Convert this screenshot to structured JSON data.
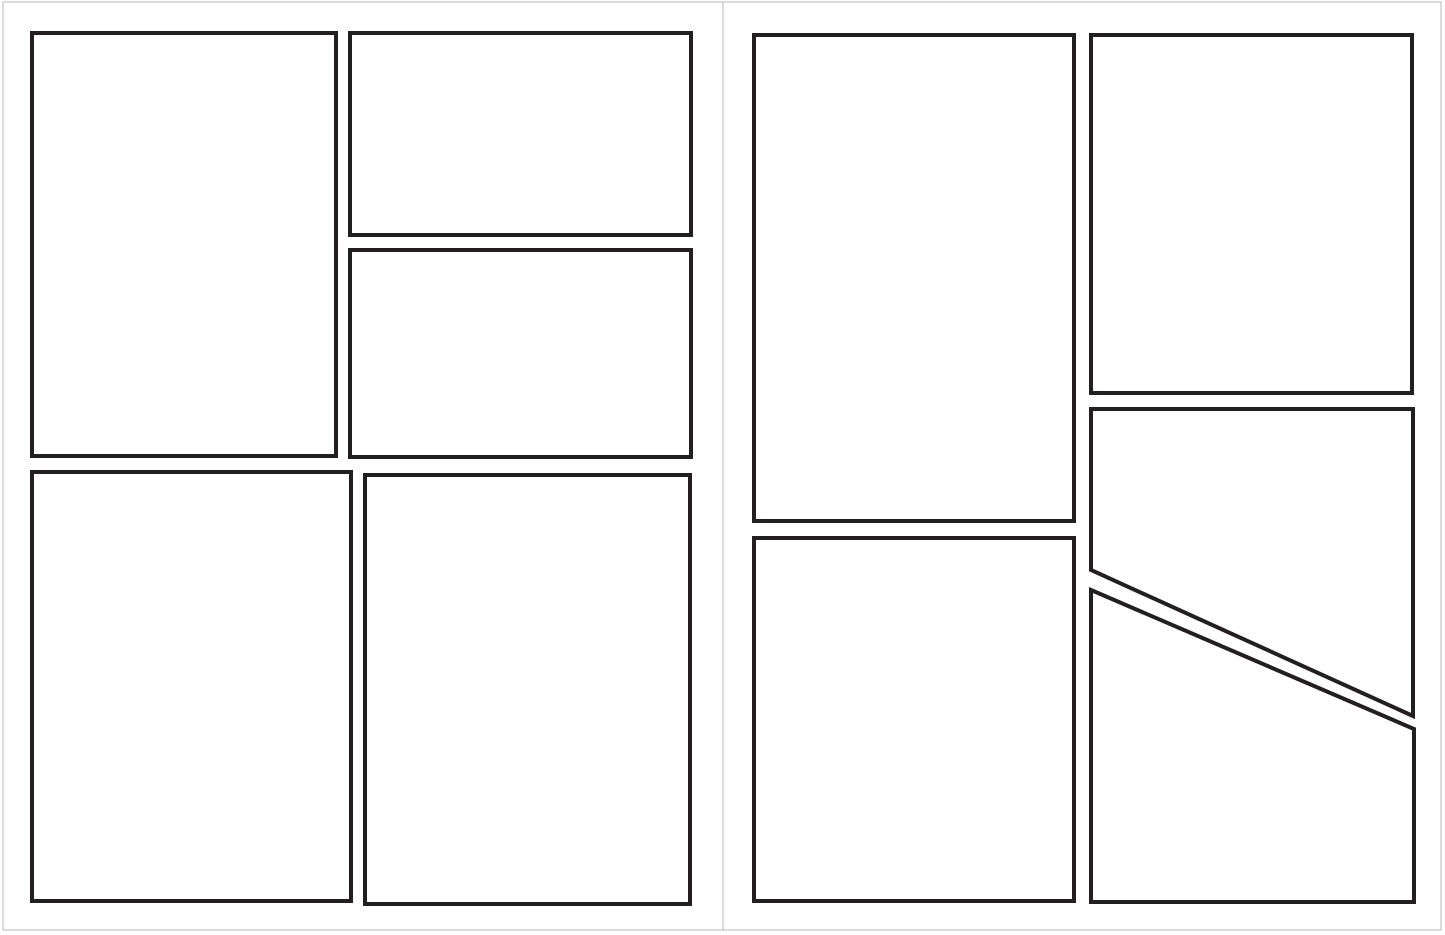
{
  "document": {
    "kind": "blank comic page layout template, two-page spread, no text",
    "background_color": "#ffffff",
    "page_border_color": "#b9b9b9",
    "panel_stroke_color": "#231f20",
    "panel_stroke_width": 4,
    "panel_fill": "#ffffff"
  },
  "canvas": {
    "width": 1445,
    "height": 935
  },
  "pages": [
    {
      "name": "left-page",
      "rect": {
        "x": 3,
        "y": 2,
        "width": 720,
        "height": 928
      },
      "panels": [
        {
          "id": "panel-top-left-large",
          "points": [
            [
              32,
              33
            ],
            [
              336,
              33
            ],
            [
              336,
              456
            ],
            [
              32,
              456
            ]
          ]
        },
        {
          "id": "panel-top-right-upper",
          "points": [
            [
              350,
              33
            ],
            [
              691,
              33
            ],
            [
              691,
              235
            ],
            [
              350,
              235
            ]
          ]
        },
        {
          "id": "panel-top-right-lower",
          "points": [
            [
              350,
              250
            ],
            [
              691,
              250
            ],
            [
              691,
              457
            ],
            [
              350,
              457
            ]
          ]
        },
        {
          "id": "panel-bottom-left",
          "points": [
            [
              32,
              472
            ],
            [
              351,
              472
            ],
            [
              351,
              901
            ],
            [
              32,
              901
            ]
          ]
        },
        {
          "id": "panel-bottom-right",
          "points": [
            [
              365,
              475
            ],
            [
              690,
              475
            ],
            [
              690,
              904
            ],
            [
              365,
              904
            ]
          ]
        }
      ]
    },
    {
      "name": "right-page",
      "rect": {
        "x": 723,
        "y": 2,
        "width": 718,
        "height": 928
      },
      "panels": [
        {
          "id": "panel-top-left-tall",
          "points": [
            [
              754,
              35
            ],
            [
              1074,
              35
            ],
            [
              1074,
              521
            ],
            [
              754,
              521
            ]
          ]
        },
        {
          "id": "panel-top-right",
          "points": [
            [
              1091,
              35
            ],
            [
              1412,
              35
            ],
            [
              1412,
              393
            ],
            [
              1091,
              393
            ]
          ]
        },
        {
          "id": "panel-mid-right-diagonal",
          "points": [
            [
              1091,
              409
            ],
            [
              1413,
              409
            ],
            [
              1413,
              716
            ],
            [
              1091,
              570
            ]
          ]
        },
        {
          "id": "panel-bottom-left",
          "points": [
            [
              754,
              538
            ],
            [
              1074,
              538
            ],
            [
              1074,
              901
            ],
            [
              754,
              901
            ]
          ]
        },
        {
          "id": "panel-bottom-right-diagonal",
          "points": [
            [
              1091,
              590
            ],
            [
              1414,
              729
            ],
            [
              1414,
              902
            ],
            [
              1091,
              902
            ]
          ]
        }
      ]
    }
  ]
}
